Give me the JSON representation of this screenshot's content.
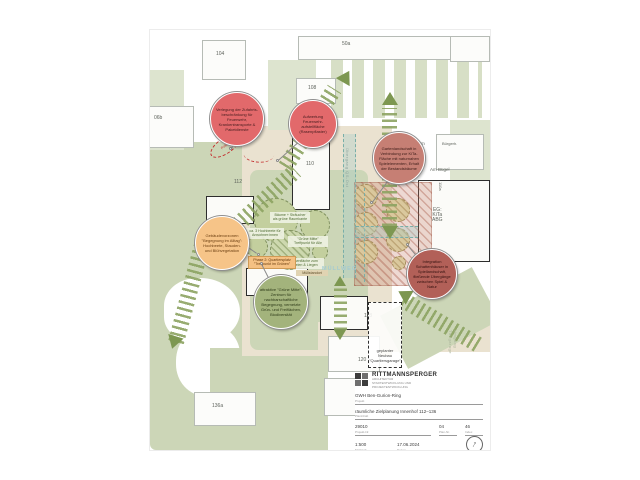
{
  "map": {
    "buildings": {
      "n104": "104",
      "n06b": "06b",
      "n50a": "50a",
      "n108": "108",
      "n110": "110",
      "n112": "112",
      "n114": "114",
      "n116": "116",
      "n118": "118",
      "n120": "120",
      "n122": "122",
      "n136a": "136a",
      "n110a": "110a"
    },
    "labels": {
      "zentrum": "Zentrum",
      "am_buegel": "Am Bügel",
      "buergerhaus": "Bürgerh.",
      "kita": "EG:\nKiTa\nABG",
      "uebergang": "Übergang QS-Ost",
      "tiefgarage": "Umgang Tiefgarage",
      "muellweg": "MÜLLWEG",
      "poller": "Poller",
      "neubau": "geplanter\nNeubau\n\"Quartiersgarage\""
    },
    "bubbles": [
      {
        "id": "zufahrt",
        "text": "Verlegung der Zufahrts­beschränkung für Feuerwehr, Krankentransporte & Paketdienste"
      },
      {
        "id": "feuerwehr",
        "text": "Aufwertung Feuerwehr­aufstellfläche (Rasenpflaster)"
      },
      {
        "id": "kita-garten",
        "text": "Gartenlandschaft in Verbindung zur KiTa-Fläche mit naturnahen Spielelementen, Erhalt der Bestandsbäume"
      },
      {
        "id": "vorzonen",
        "text": "Gebäudevorzonen \"Begegnung im Alltag\": Hochbeete, Stauden- und Blühvegetation"
      },
      {
        "id": "gruene-mitte",
        "text": "attraktive \"Grüne Mitte\": Zentrum für nachbarschaftliche Begegnung, vernetzte Grün- und Freiflächen, Biodiversität"
      },
      {
        "id": "schattenhaeuser",
        "text": "Integration Schattenhäuser in Spiellandschaft, fließende Übergänge zwischen Spiel & Natur"
      }
    ],
    "notes": {
      "trees": "Bäume + Sträucher\nals grüne Raumkante",
      "beds": "ca. 3 Hochbeete für\nAnwohner:innen",
      "lawn": "Rasenfläche zum\nSpielen & Liegen",
      "mitte": "\"Grüne Mitte\"\nTreffpunkt für Alle",
      "phase": "Phase 2: Quartiersplatz\n\"Treffpunkt im Grünen\"",
      "muell": "Müllstandort"
    }
  },
  "titleblock": {
    "firm": "RITTMANNSPERGER",
    "firm_sub1": "ARCHITEKTUR",
    "firm_sub2": "STADTENTWICKLUNG UND",
    "firm_sub3": "PROJEKTENTWICKLUNG",
    "project": "GWH Ben-Gurion-Ring",
    "project_label": "Projekt",
    "content": "räumliche Zielplanung Innenhof 112–136",
    "content_label": "Planinhalt",
    "proj_no": "29010",
    "proj_no_label": "Projekt-Nr.",
    "plan_no": "04",
    "plan_no_label": "Plan-Nr.",
    "index_no": "46",
    "index_label": "Index",
    "scale": "1:500",
    "scale_label": "Maßstab",
    "date": "17.06.2024",
    "date_label": "Datum",
    "client": "GWH Wohnungsbaugesellschaft",
    "client_label": "Bauherr",
    "fine_print": "Alle Maße sind am Bau zu prüfen. Abweichungen sind dem Planverfasser zu melden."
  },
  "colors": {
    "accent_red": "#e2696b",
    "accent_orange": "#f6c488",
    "accent_green": "#a3b37c",
    "band_green": "#8ca361",
    "corridor_teal": "#79aea8"
  }
}
